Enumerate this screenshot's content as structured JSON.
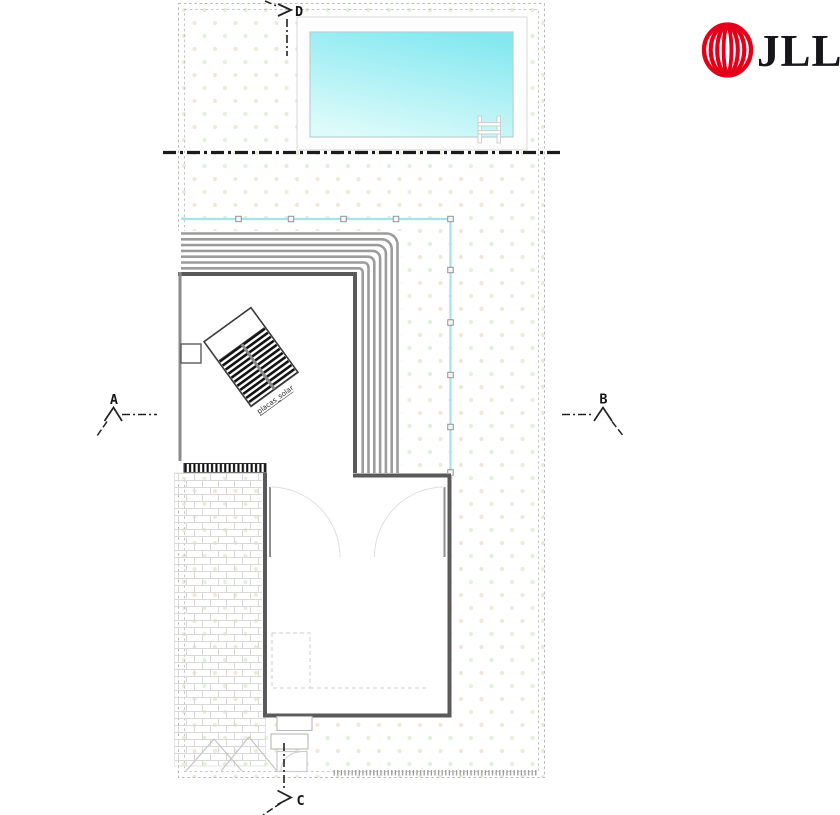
{
  "drawing": {
    "section_markers": {
      "top": "D",
      "left": "A",
      "right": "B",
      "bottom": "C"
    },
    "solar_label": "placas_solar",
    "colors": {
      "pool_top": "#85e8f0",
      "pool_bottom": "#dcfbfa",
      "fence": "#a5e3ea",
      "roof_stripe": "#9c9c9c",
      "wall": "#5a5a5a",
      "dot_green": "#e4efdc",
      "dot_tan": "#efe9d9",
      "brick": "#d9d9d9"
    }
  },
  "logo": {
    "text": "JLL",
    "brand_red": "#e2001a",
    "text_color": "#17171b"
  }
}
